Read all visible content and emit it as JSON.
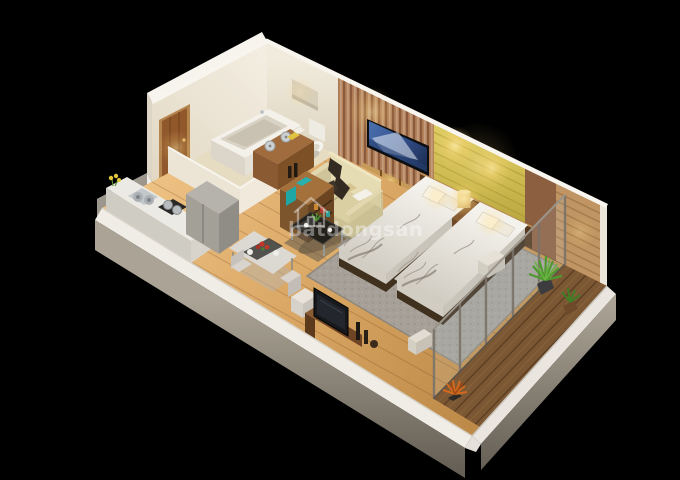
{
  "background": "#000000",
  "watermark": {
    "icon": "house-icon",
    "text": "batdongsan",
    "color": "rgba(255,255,255,0.40)"
  },
  "palette": {
    "floor_wood": "#d7a360",
    "balcony_deck": "#7b5733",
    "walls_white": "#efe8da",
    "gold_panel": "#c9b64c",
    "copper_slat_panel": "#b5825a",
    "wood_panel": "#8d5f41",
    "wardrobe_slats": "#c09463",
    "bedding": "#ebe8e2",
    "bed_frame": "#40301e",
    "rug": "#a6a098",
    "sofa": "#d9cfa2",
    "accent_teal": "#27b0ae",
    "plant_green": "#4f9a2e",
    "plant_orange": "#d2691e",
    "tv_screen_blue": "#33508c"
  }
}
